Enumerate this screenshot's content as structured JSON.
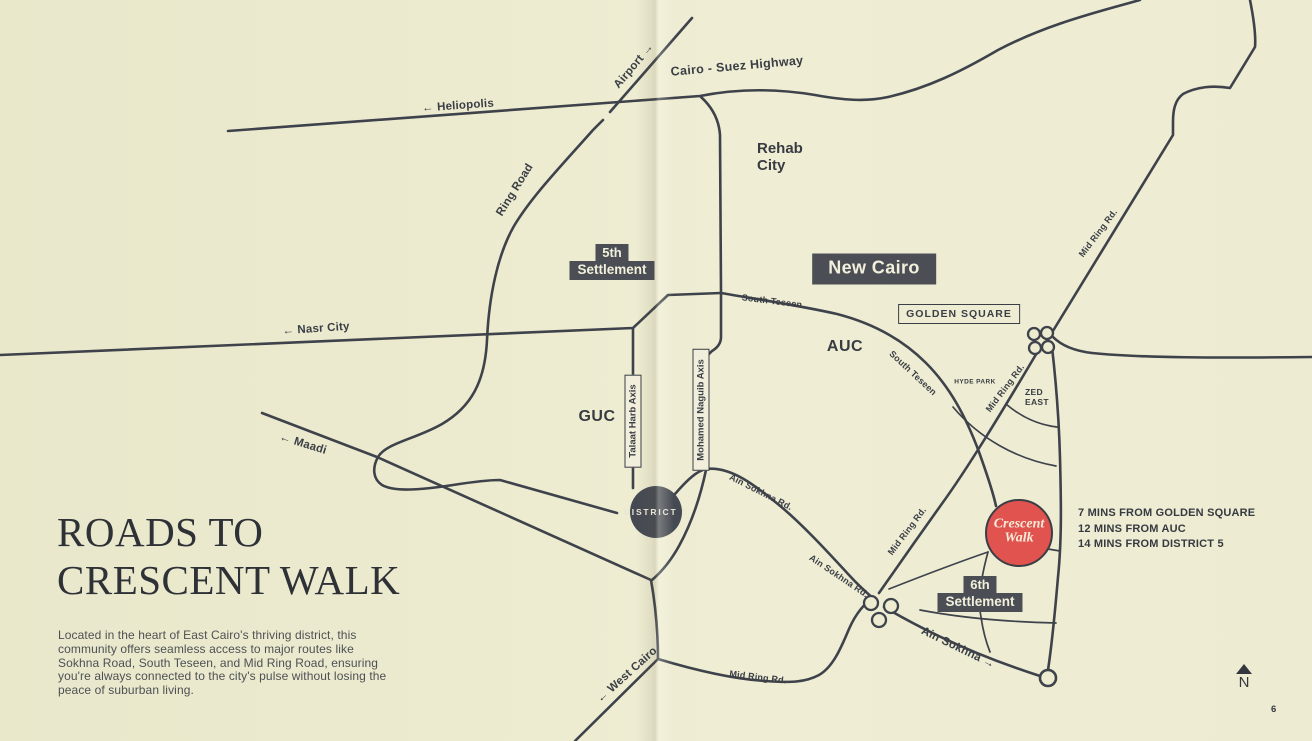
{
  "page": {
    "number": "6"
  },
  "title": {
    "line1": "ROADS TO",
    "line2": "CRESCENT WALK"
  },
  "description": "Located in the heart of East Cairo's thriving district, this community offers seamless access to major routes like Sokhna Road, South Teseen, and Mid Ring Road, ensuring you're always connected to the city's pulse without losing the peace of suburban living.",
  "compass": {
    "label": "N"
  },
  "colors": {
    "background": "#edebd0",
    "road": "#3e424a",
    "badge": "#4b4f55",
    "marker_red": "#e0534e",
    "title_text": "#2e3237"
  },
  "map": {
    "roads": {
      "heliopolis": "← Heliopolis",
      "airport": "Airport →",
      "cairo_suez": "Cairo - Suez Highway",
      "ring_road": "Ring Road",
      "nasr_city": "← Nasr City",
      "maadi": "← Maadi",
      "south_teseen": "South Teseen",
      "mid_ring": "Mid Ring Rd.",
      "ain_sokhna_rd": "Ain Sokhna Rd.",
      "ain_sokhna_dir": "Ain Sokhna →",
      "west_cairo": "← West Cairo"
    },
    "places": {
      "rehab_city": {
        "line1": "Rehab",
        "line2": "City"
      },
      "new_cairo": "New Cairo",
      "golden_square": "GOLDEN SQUARE",
      "auc": "AUC",
      "guc": "GUC",
      "hyde_park": "HYDE PARK",
      "zed_east": {
        "line1": "ZED",
        "line2": "EAST"
      },
      "settlement5": {
        "line1": "5th",
        "line2": "Settlement"
      },
      "settlement6": {
        "line1": "6th",
        "line2": "Settlement"
      },
      "district5": "DISTRICT 5"
    },
    "axes": {
      "talaat": "Talaat Harb Axis",
      "naguib": "Mohamed Naguib Axis"
    },
    "marker": {
      "line1": "Crescent",
      "line2": "Walk"
    },
    "distances": [
      "7 MINS FROM GOLDEN SQUARE",
      "12 MINS FROM AUC",
      "14 MINS FROM DISTRICT 5"
    ]
  }
}
